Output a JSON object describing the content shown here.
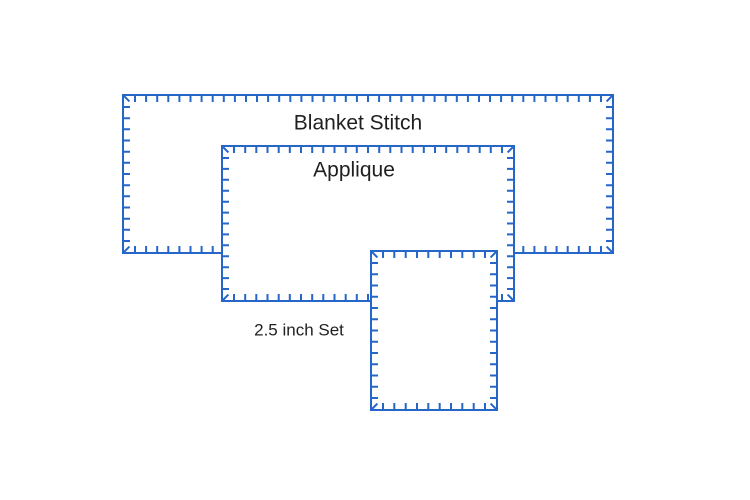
{
  "canvas": {
    "width": 750,
    "height": 500,
    "background": "#ffffff"
  },
  "stitch_style": {
    "color": "#2566c8",
    "fill": "#ffffff",
    "line_width": 2,
    "tick_length": 7,
    "tick_spacing": 11,
    "corner_margin": 12,
    "corner_tick_length": 9
  },
  "shapes": [
    {
      "name": "blanket-stitch-template-large",
      "x": 123,
      "y": 95,
      "width": 490,
      "height": 158
    },
    {
      "name": "blanket-stitch-template-medium",
      "x": 222,
      "y": 146,
      "width": 292,
      "height": 155
    },
    {
      "name": "blanket-stitch-template-small",
      "x": 371,
      "y": 251,
      "width": 126,
      "height": 159
    }
  ],
  "labels": [
    {
      "id": "blanket-stitch",
      "text": "Blanket Stitch",
      "x": 358,
      "y": 123,
      "font_size": 21
    },
    {
      "id": "applique",
      "text": "Applique",
      "x": 354,
      "y": 170,
      "font_size": 21
    },
    {
      "id": "size-set",
      "text": "2.5 inch Set",
      "x": 299,
      "y": 330,
      "font_size": 17
    }
  ],
  "text_color": "#1f1f1f"
}
